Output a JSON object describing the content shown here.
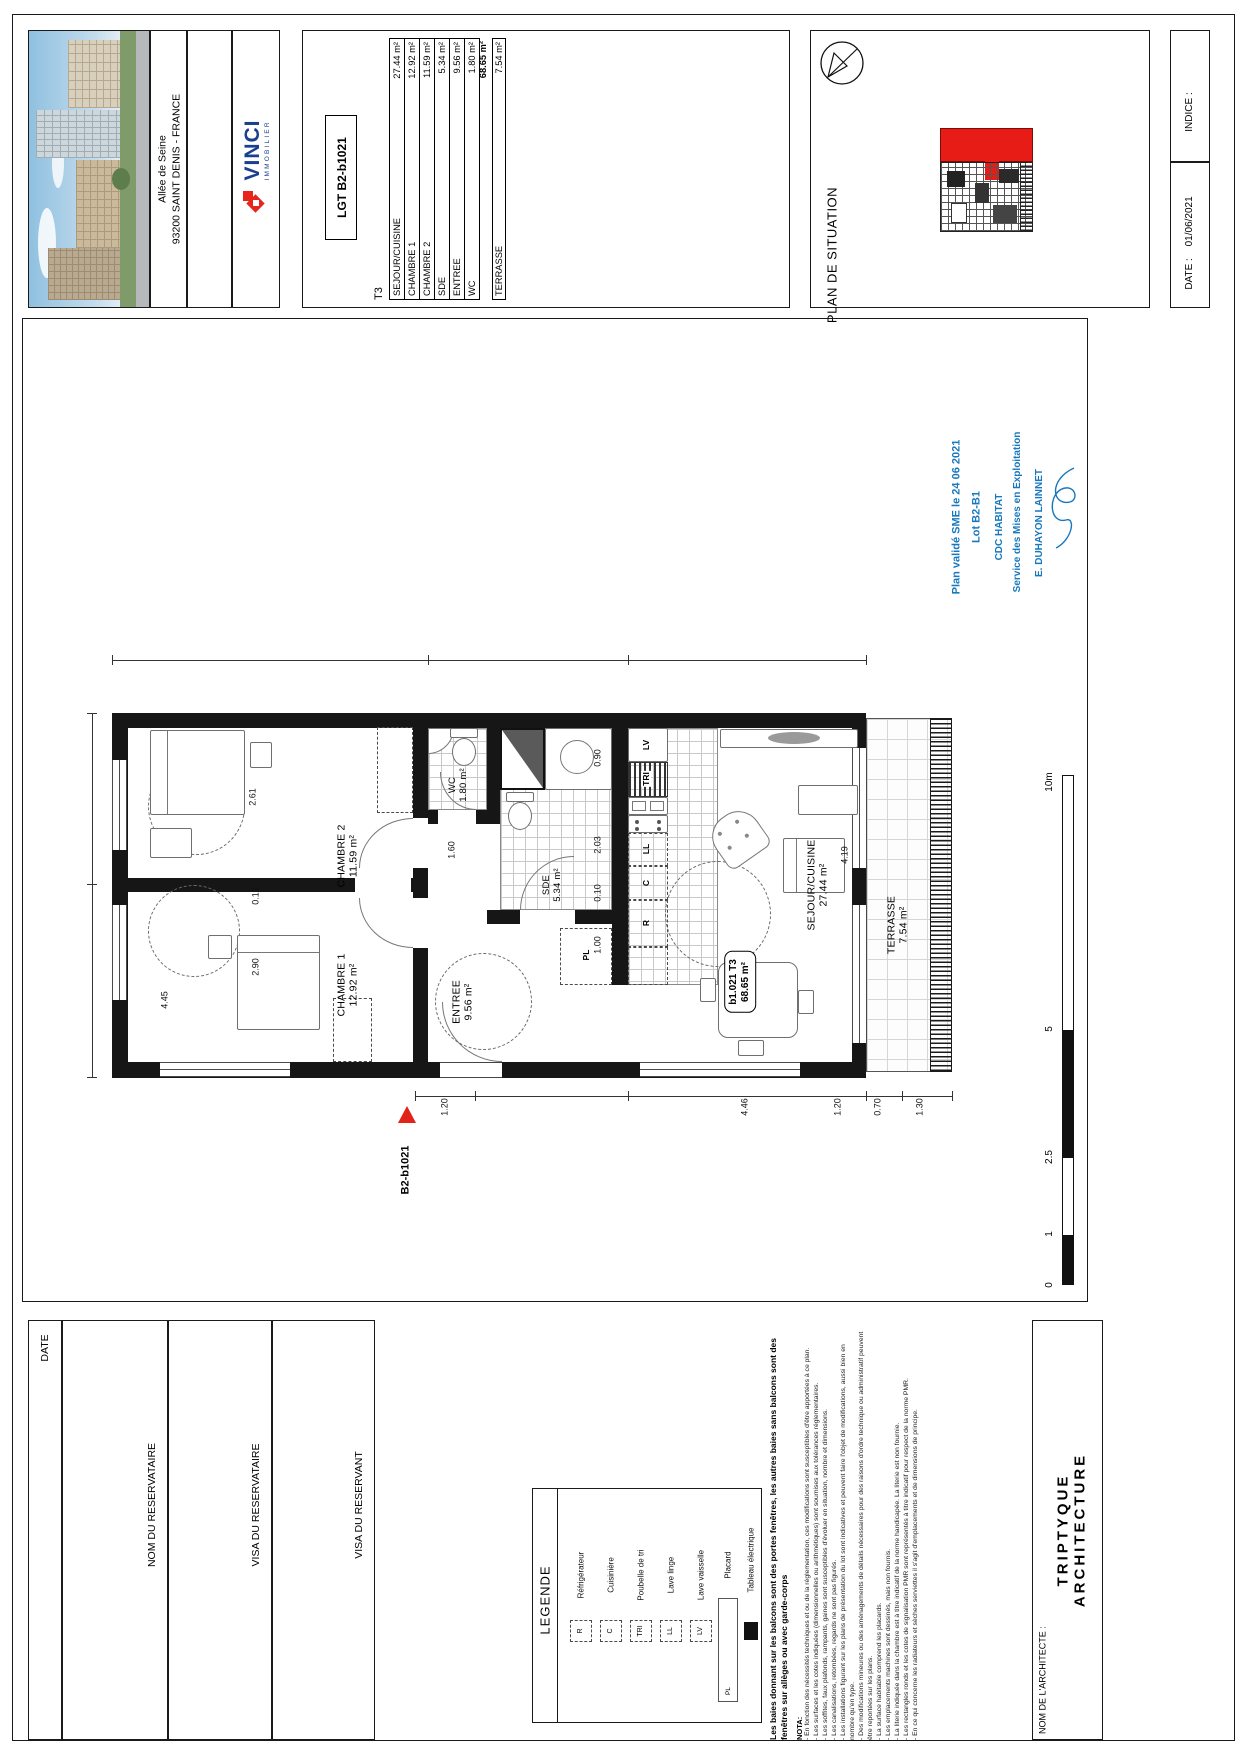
{
  "title_block": {
    "address_line1": "Allée de Seine",
    "address_line2": "93200 SAINT DENIS - FRANCE",
    "brand": {
      "name": "VINCI",
      "division": "IMMOBILIER"
    },
    "lot_code": "LGT B2-b1021",
    "unit_type": "T3",
    "area_rows": [
      {
        "label": "SEJOUR/CUISINE",
        "value": "27.44 m²"
      },
      {
        "label": "CHAMBRE 1",
        "value": "12.92 m²"
      },
      {
        "label": "CHAMBRE 2",
        "value": "11.59 m²"
      },
      {
        "label": "SDE",
        "value": "5.34 m²"
      },
      {
        "label": "ENTREE",
        "value": "9.56 m²"
      },
      {
        "label": "WC",
        "value": "1.80 m²"
      }
    ],
    "total_value": "68.65 m²",
    "terrace_row": {
      "label": "TERRASSE",
      "value": "7.54 m²"
    },
    "situation_title": "PLAN DE SITUATION",
    "indice_label": "INDICE :",
    "date_label": "DATE :",
    "date_value": "01/06/2021"
  },
  "validation": {
    "color": "#1878be",
    "lines": [
      "Plan validé SME le 24 06 2021",
      "Lot B2-B1",
      "CDC HABITAT",
      "Service des Mises en Exploitation",
      "E. DUHAYON LAINNET"
    ]
  },
  "plan": {
    "marker_label": "B2-b1021",
    "unit_tag_line1": "b1.021 T3",
    "unit_tag_line2": "68.65 m²",
    "rooms": [
      {
        "name": "CHAMBRE 2",
        "area": "11.59 m²"
      },
      {
        "name": "CHAMBRE 1",
        "area": "12.92 m²"
      },
      {
        "name": "WC",
        "area": "1.80 m²"
      },
      {
        "name": "SDE",
        "area": "5.34 m²"
      },
      {
        "name": "ENTREE",
        "area": "9.56 m²"
      },
      {
        "name": "SEJOUR/CUISINE",
        "area": "27.44 m²"
      },
      {
        "name": "TERRASSE",
        "area": "7.54 m²"
      }
    ],
    "appliance_codes": {
      "lv": "LV",
      "tri": "TRI",
      "ll": "LL",
      "c": "C",
      "r": "R",
      "pl": "PL"
    },
    "dims": [
      "2.61",
      "0.10",
      "2.90",
      "4.45",
      "0.90",
      "2.03",
      "0.10",
      "1.00",
      "1.60",
      "1.20",
      "4.46",
      "1.20",
      "4.19",
      "0.70",
      "1.30"
    ]
  },
  "scale_bar": {
    "labels": [
      "0",
      "1",
      "2.5",
      "5",
      "10m"
    ]
  },
  "footer": {
    "reservation_boxes": [
      "DATE",
      "NOM DU RESERVATAIRE",
      "VISA DU RESERVATAIRE",
      "VISA DU RESERVANT"
    ],
    "legend": {
      "title": "LEGENDE",
      "items": [
        {
          "code": "R",
          "label": "Réfrigérateur"
        },
        {
          "code": "C",
          "label": "Cuisinière"
        },
        {
          "code": "TRI",
          "label": "Poubelle de tri"
        },
        {
          "code": "LL",
          "label": "Lave linge"
        },
        {
          "code": "LV",
          "label": "Lave vaisselle"
        },
        {
          "code": "PL",
          "label": "Placard"
        },
        {
          "code": "",
          "label": "Tableau électrique"
        }
      ]
    },
    "nota": {
      "intro": "Les baies donnant sur les balcons sont des portes fenêtres, les autres baies sans balcons sont des fenêtres sur allèges ou avec garde-corps",
      "title": "NOTA:",
      "items": [
        "- En fonction des nécessités techniques et ou de la réglementation, ces modifications sont susceptibles d'être apportées à ce plan.",
        "- Les surfaces et les cotes indiquées (dimensionnelles ou arithmétiques) sont soumises aux tolérances réglementaires.",
        "- Les soffites, faux plafonds, rampants, gaines sont susceptibles d'évoluer en situation, nombre et dimensions.",
        "- Les canalisations, retombées, regards ne sont pas figurés.",
        "- Les installations figurant sur les plans de présentation du lot sont indicatives et peuvent faire l'objet de modifications, aussi bien en nombre qu'en type.",
        "- Des modifications mineures ou des aménagements de détails nécessaires pour des raisons d'ordre technique ou administratif peuvent être reportées sur les plans.",
        "- La surface habitable comprend les placards.",
        "- Les emplacements machines sont dessinés, mais non fournis.",
        "- La literie indiquée dans la chambre est à titre indicatif de la norme handicapée. La literie est non fournie.",
        "- Les rectangles ronds et les cotes de signalisation PMR sont représentés à titre indicatif pour respect de la norme PMR.",
        "- En ce qui concerne les radiateurs et sèches serviettes il s'agit d'emplacements et de dimensions de principe."
      ]
    },
    "architect": {
      "label": "NOM DE L'ARCHITECTE :",
      "name_line1": "TRIPTYQUE",
      "name_line2": "ARCHITECTURE"
    }
  }
}
